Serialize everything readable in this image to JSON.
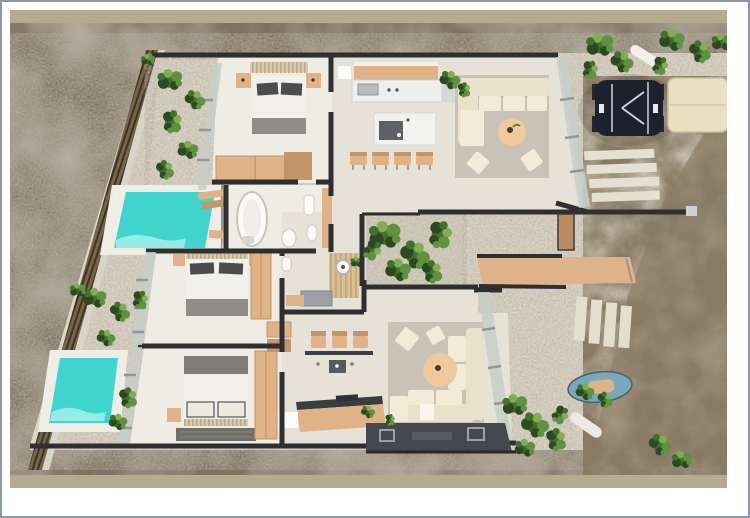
{
  "meta": {
    "title": "Top-down 3D architectural render of a villa floor plan",
    "view": "aerial top view",
    "visible_text": []
  },
  "palette": {
    "page_bg": "#ffffff",
    "frame_border": "#8b96ac",
    "photo_strip": "#b4ab91",
    "ground": "#b7aea0",
    "ground_dark": "#7e7362",
    "gravel": "#ddd7ca",
    "gravel_dark": "#b7af9d",
    "dirt": "#a2947e",
    "dirt_dark": "#887a63",
    "wall": "#2e2f31",
    "floor": "#e7e2d8",
    "floor_bright": "#efece4",
    "glass": "#c6cfc8",
    "mullion": "#8e979c",
    "fence": "#75654a",
    "fence_dark": "#3f3422",
    "wood": "#e0b287",
    "wood_dark": "#c2956a",
    "cream": "#e9e1ca",
    "cream_light": "#f2ebd8",
    "rug": "#c9c3b7",
    "table": "#efc89c",
    "pool": "#3fd5cd",
    "pool_light": "#a5efe9",
    "pool_deck": "#f0ede6",
    "duvet": "#f2f0ea",
    "pillow_dark": "#4a4c4e",
    "throw": "#8e8d88",
    "plant_dark": "#2c4a22",
    "plant_mid": "#43702f",
    "plant_light": "#5f9140",
    "plant_pale": "#7fae54",
    "car_body": "#1b222e",
    "car_trim": "#cdd0d5",
    "canopy": "#e9e0bf",
    "platform": "#45494d",
    "platform_hatch": "#9aa0a5",
    "mat_grey": "#9ba1a6",
    "shower_wood": "#d8c096",
    "shower_wood_dark": "#c2a778",
    "headboard": "#d8cbb2",
    "headboard_dark": "#b7a98a",
    "water_item": "#7ba8b8"
  },
  "scene": {
    "type": "architectural_render_floor_plan",
    "rooms": [
      {
        "name": "bedroom-1"
      },
      {
        "name": "bedroom-2"
      },
      {
        "name": "bedroom-3"
      },
      {
        "name": "bathroom-tub"
      },
      {
        "name": "bathroom-shower"
      },
      {
        "name": "kitchen-dining"
      },
      {
        "name": "living-room"
      },
      {
        "name": "second-lounge"
      },
      {
        "name": "courtyard-garden"
      }
    ],
    "objects": [
      {
        "name": "pool-large"
      },
      {
        "name": "pool-small"
      },
      {
        "name": "perimeter-fence"
      },
      {
        "name": "vintage-car"
      },
      {
        "name": "carport-canopy"
      },
      {
        "name": "driveway-pavers"
      },
      {
        "name": "garden-plants"
      },
      {
        "name": "terrace-platform"
      },
      {
        "name": "pergola-roof"
      }
    ]
  }
}
